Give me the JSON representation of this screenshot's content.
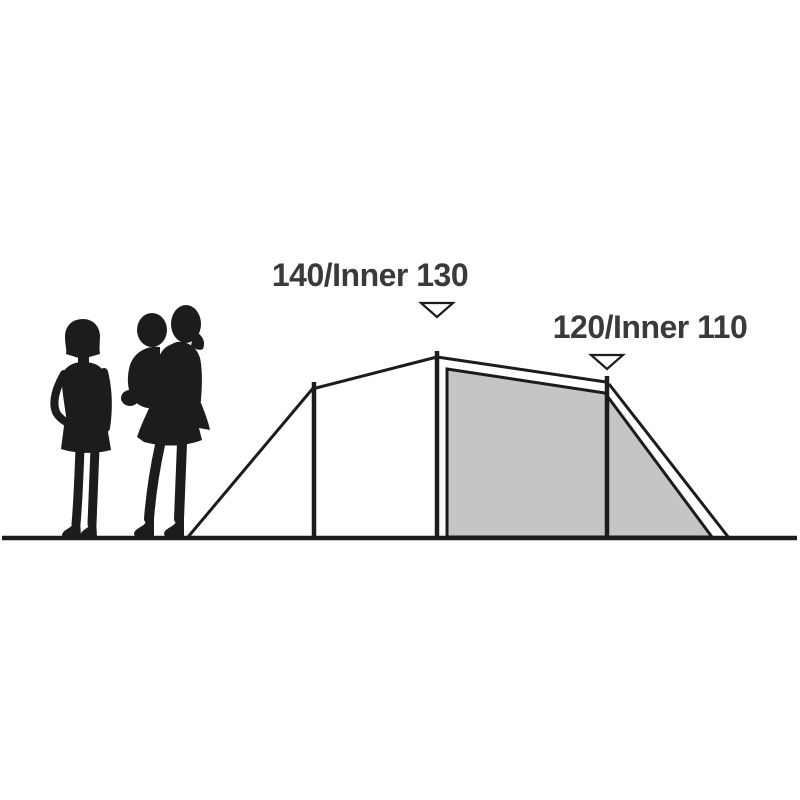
{
  "diagram": {
    "labels": {
      "main_height": "140/Inner 130",
      "rear_height": "120/Inner 110"
    },
    "heights_cm": {
      "main": {
        "outer": 140,
        "inner": 130
      },
      "rear": {
        "outer": 120,
        "inner": 110
      }
    },
    "icons": {
      "main_marker": "down-arrow-icon",
      "rear_marker": "down-arrow-icon",
      "left_figure": "adult-woman-silhouette",
      "right_figure": "woman-carrying-child-silhouette"
    },
    "colors": {
      "background": "#ffffff",
      "line": "#1c1c1a",
      "silhouette": "#1c1c1a",
      "inner_tent_fill": "#c5c5c5",
      "marker_fill": "#ffffff",
      "label_text": "#3a3a3a"
    }
  }
}
